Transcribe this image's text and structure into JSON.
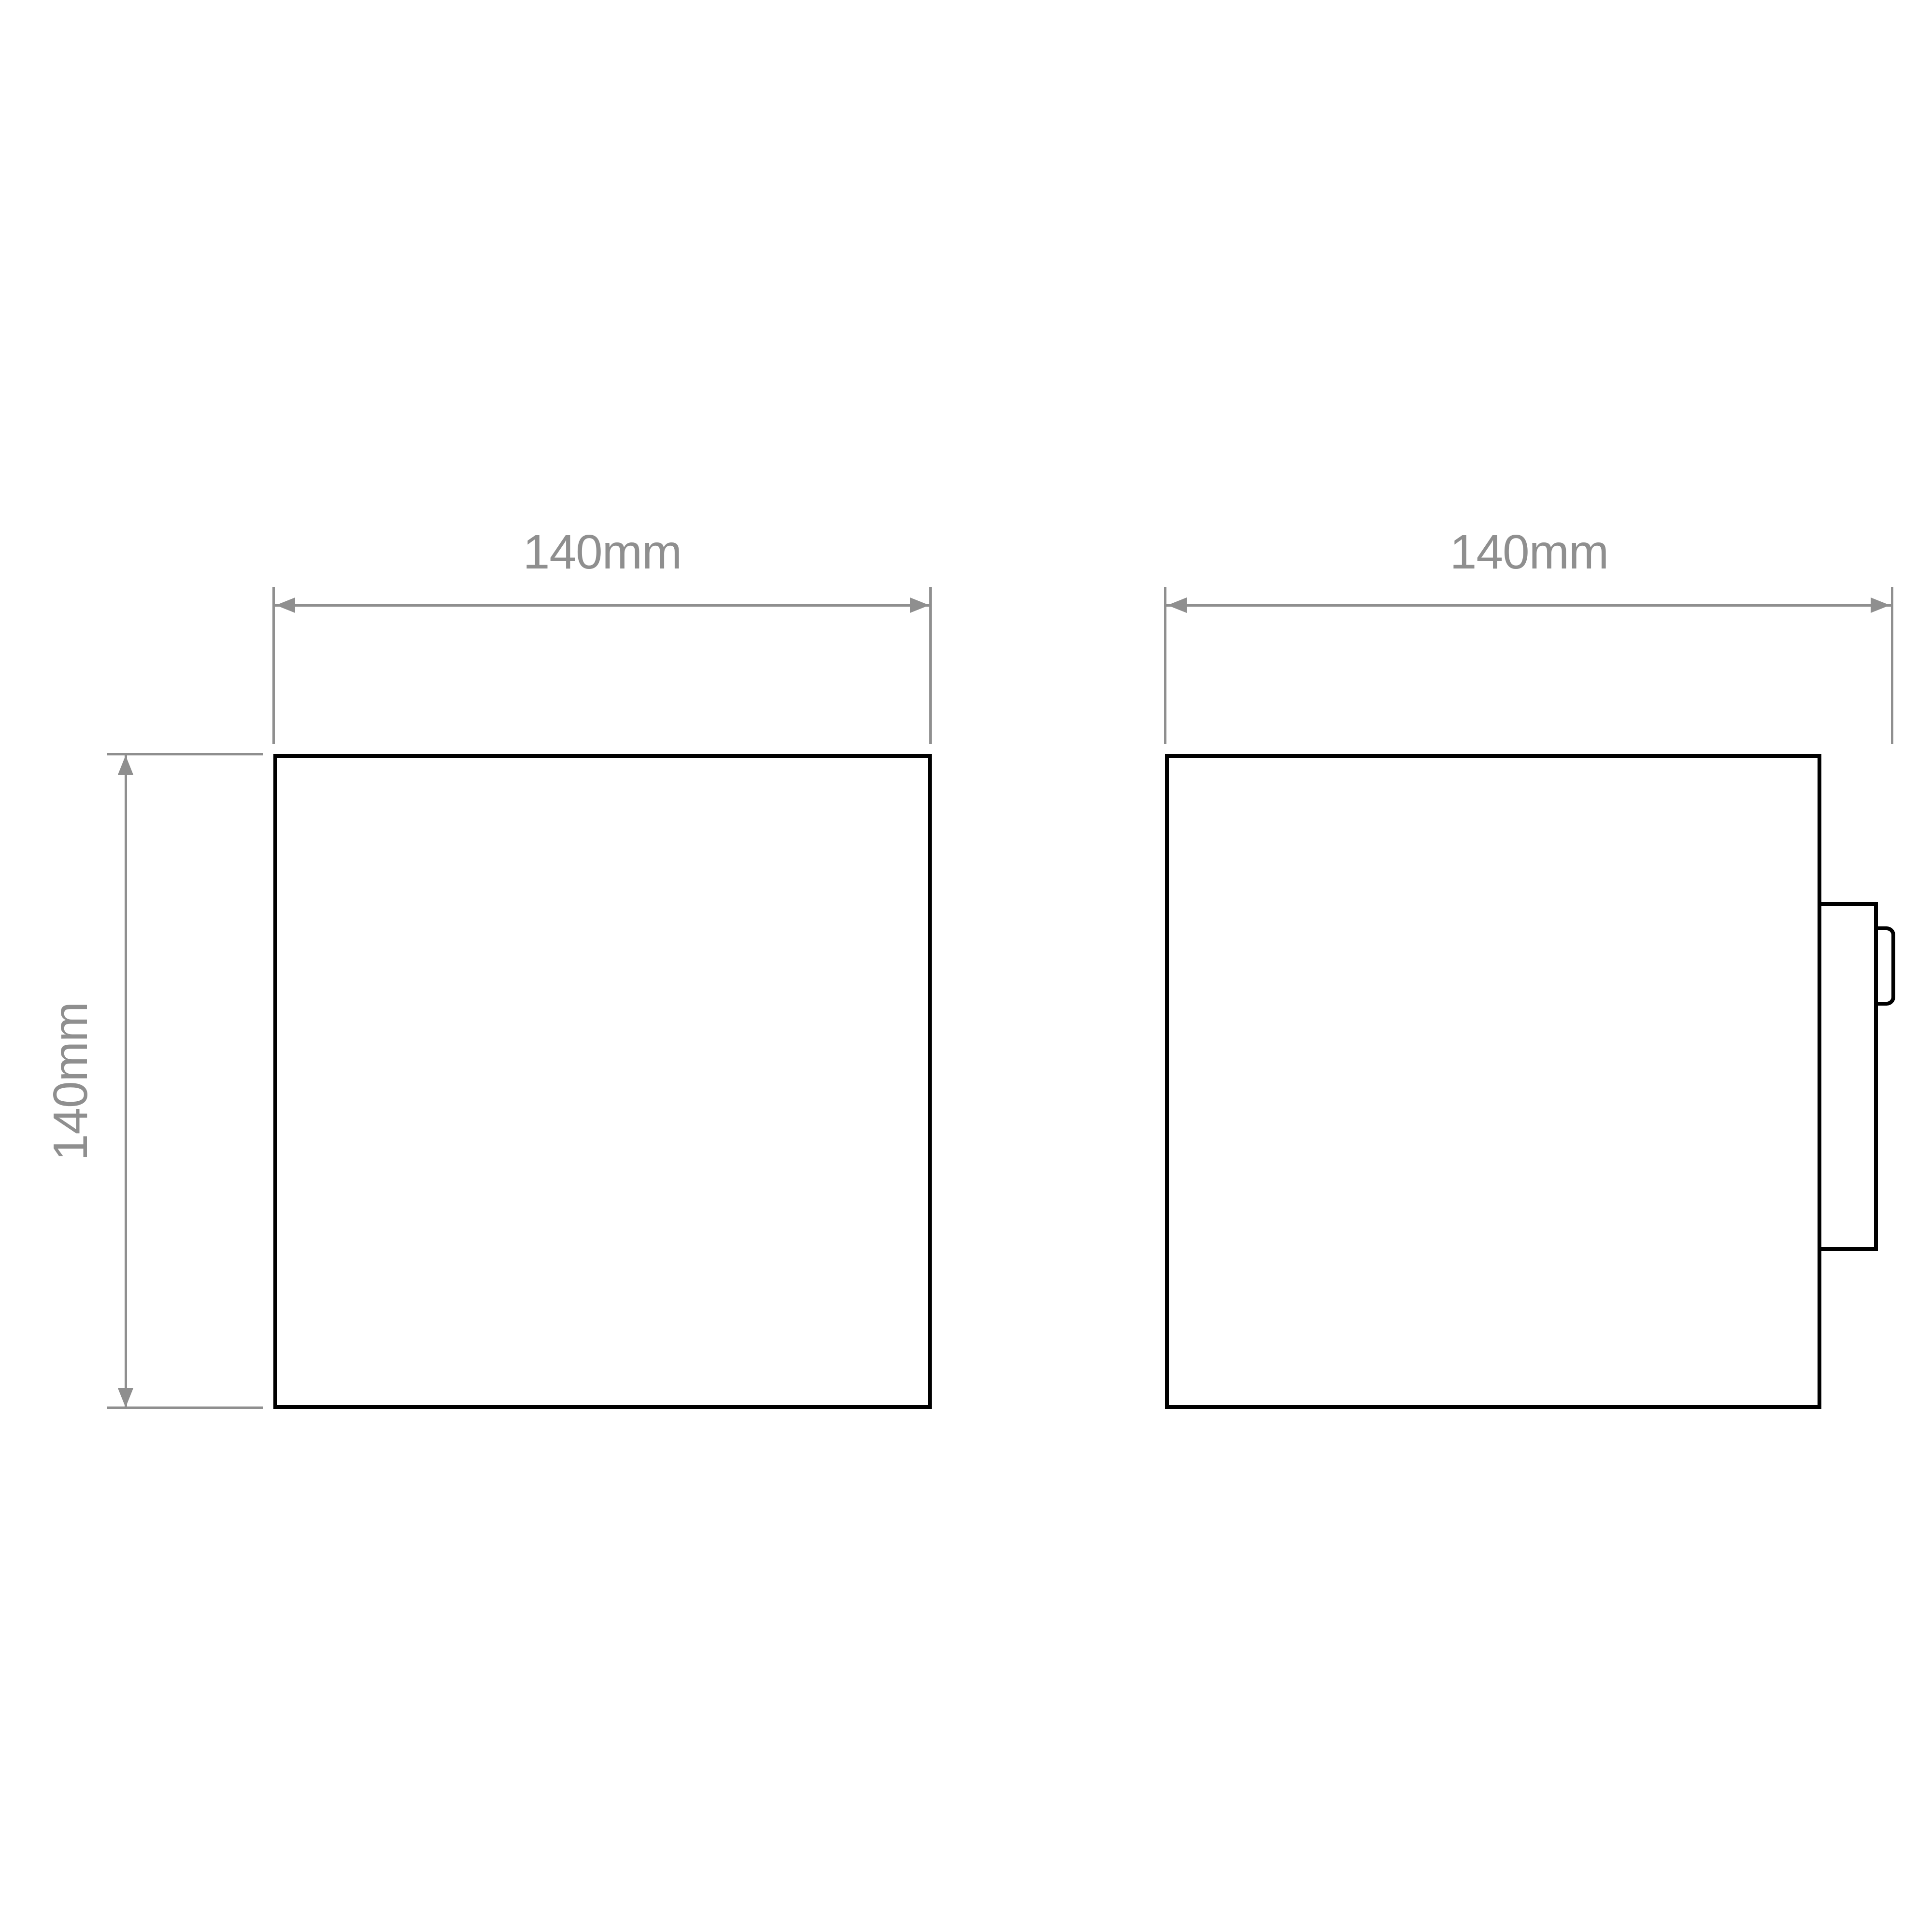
{
  "colors": {
    "background": "#ffffff",
    "dimension_gray": "#8f8f8f",
    "outline_black": "#000000"
  },
  "front_view": {
    "width_dimension_label": "140mm",
    "height_dimension_label": "140mm"
  },
  "side_view": {
    "depth_dimension_label": "140mm"
  }
}
